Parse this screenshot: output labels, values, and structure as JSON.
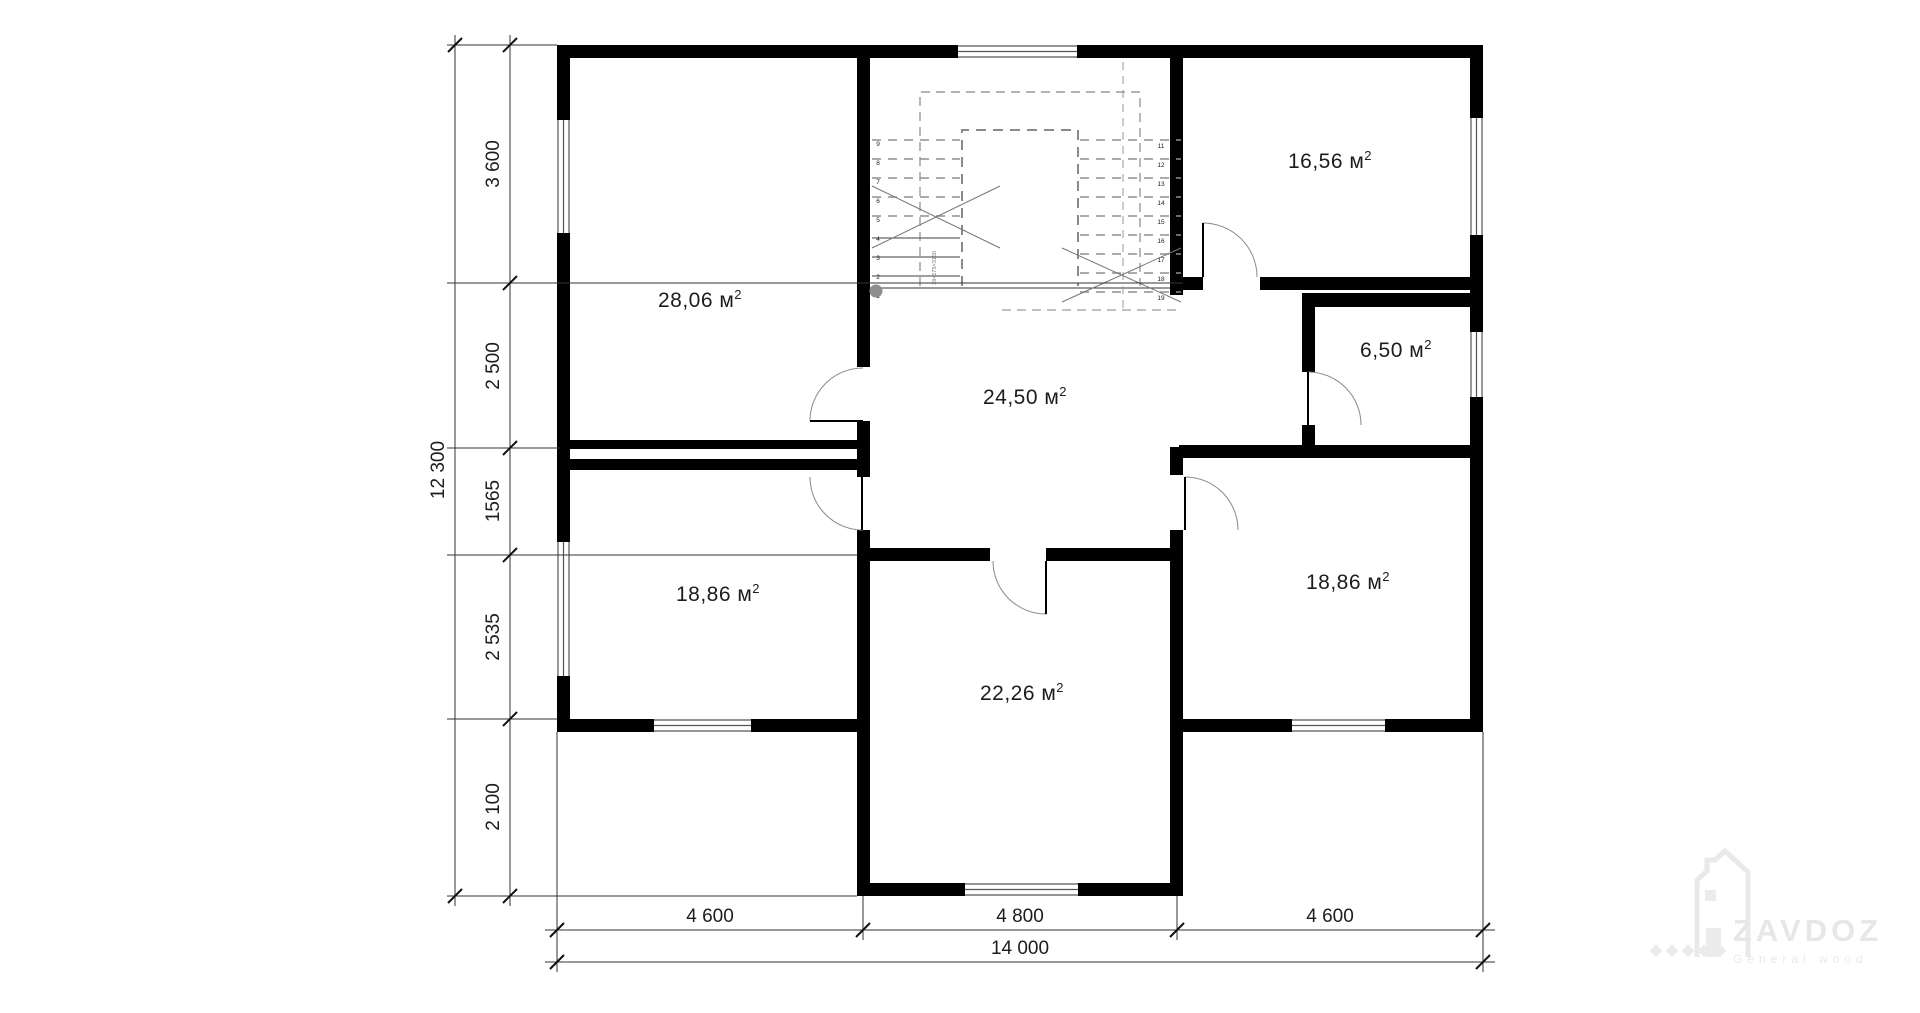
{
  "rooms": [
    {
      "label": "28,06 м",
      "sup": "2"
    },
    {
      "label": "16,56 м",
      "sup": "2"
    },
    {
      "label": "24,50 м",
      "sup": "2"
    },
    {
      "label": "6,50 м",
      "sup": "2"
    },
    {
      "label": "18,86 м",
      "sup": "2"
    },
    {
      "label": "18,86 м",
      "sup": "2"
    },
    {
      "label": "22,26 м",
      "sup": "2"
    }
  ],
  "dimensions": {
    "left_total": "12 300",
    "left_chain": [
      "3 600",
      "2 500",
      "1565",
      "2 535",
      "2 100"
    ],
    "bottom_chain": [
      "4 600",
      "4 800",
      "4 600"
    ],
    "bottom_total": "14 000"
  },
  "stairs": {
    "left_numbers": [
      "9",
      "8",
      "7",
      "6",
      "5",
      "4",
      "3",
      "2",
      "1"
    ],
    "right_numbers": [
      "11",
      "12",
      "13",
      "14",
      "15",
      "16",
      "17",
      "18",
      "19"
    ],
    "note": "18×175=3150"
  },
  "watermark": {
    "brand": "ZAVDOZ",
    "tagline": "General wood"
  },
  "colors": {
    "wall": "#000000",
    "dim": "#222222",
    "stair_dash": "#999999",
    "watermark": "#e9e9e9"
  }
}
